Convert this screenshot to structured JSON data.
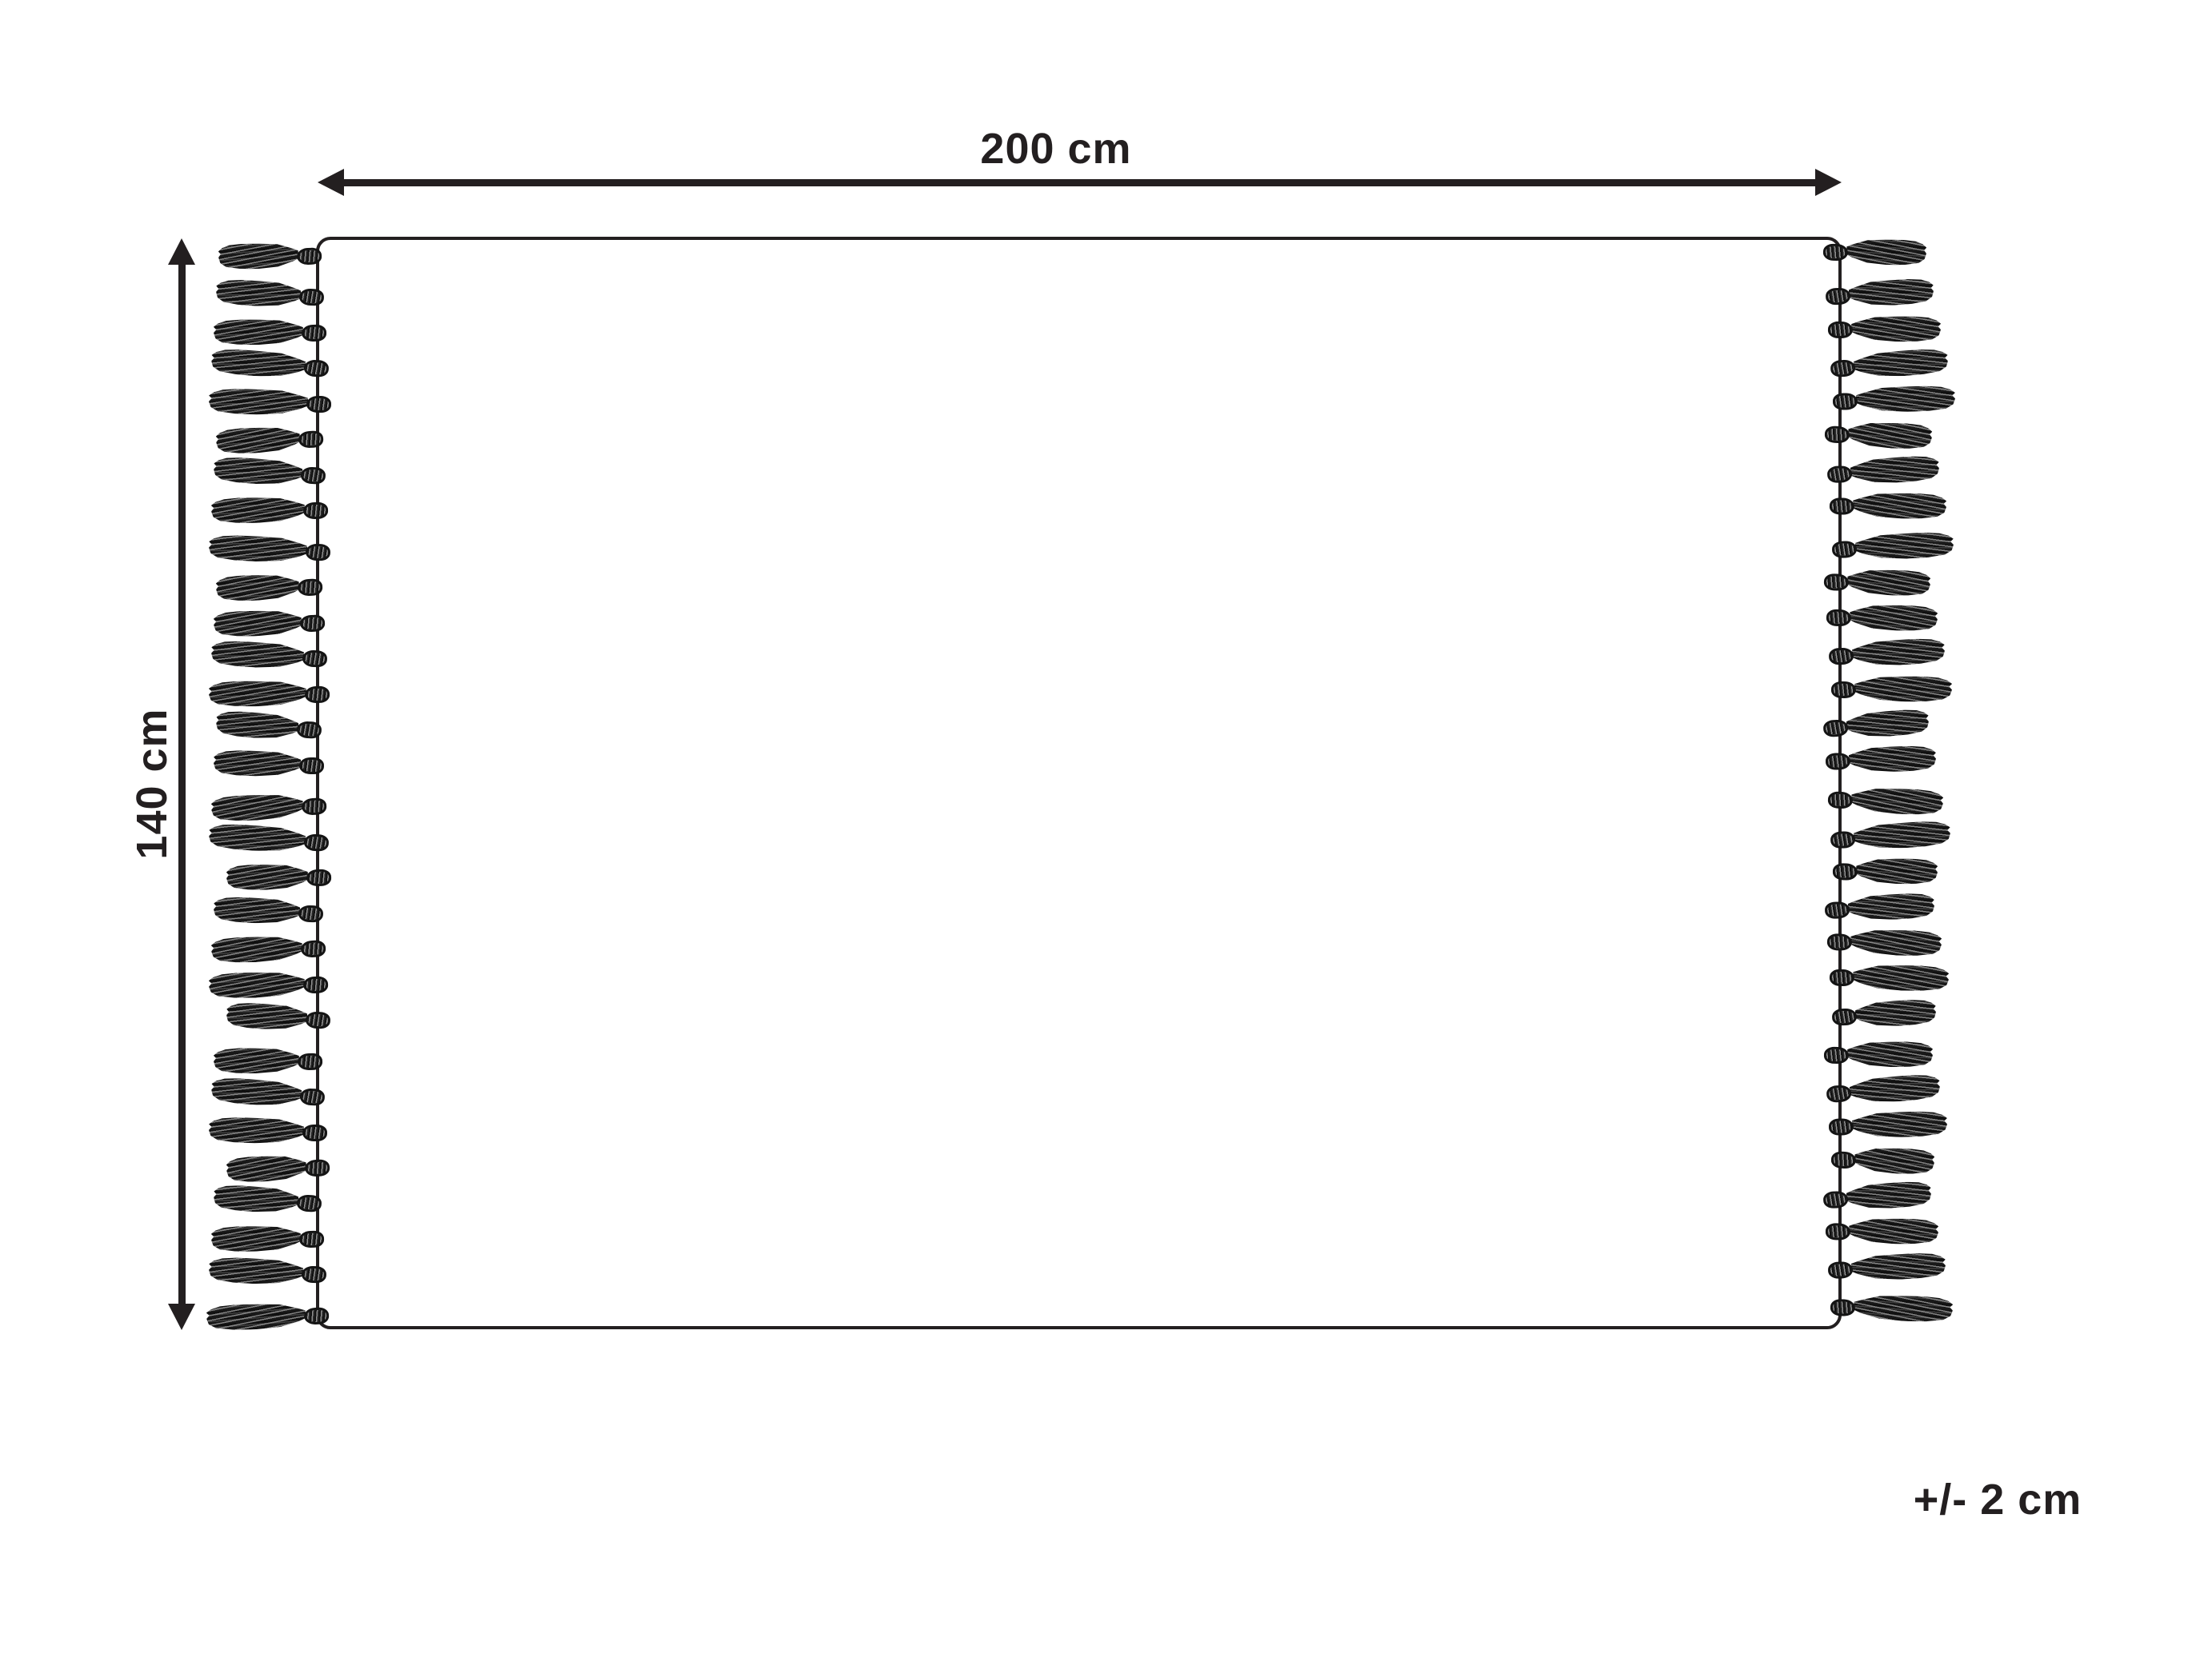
{
  "diagram": {
    "title": "rug-with-fringe dimension diagram",
    "width_label": "200 cm",
    "height_label": "140 cm",
    "tolerance_label": "+/- 2 cm",
    "colors": {
      "line": "#231f20",
      "background": "#ffffff",
      "tassel_dark": "#101010",
      "tassel_mid": "#3f3f3f",
      "tassel_light": "#8f8f8f"
    },
    "tassels": {
      "per_side": 30,
      "sides": [
        "left",
        "right"
      ]
    }
  }
}
